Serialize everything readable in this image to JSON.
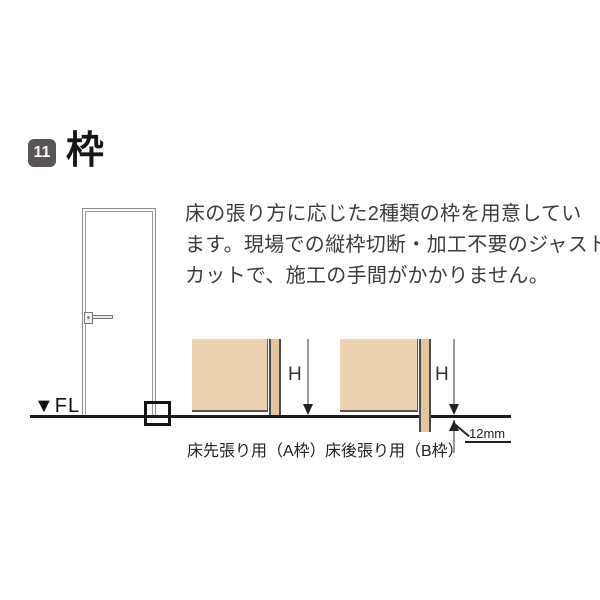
{
  "header": {
    "badge": "11",
    "title": "枠"
  },
  "description": {
    "line1": "床の張り方に応じた2種類の枠を用意してい",
    "line2": "ます。現場での縦枠切断・加工不要のジャスト",
    "line3": "カットで、施工の手間がかかりません。"
  },
  "door_figure": {
    "floor_level_label": "▼FL"
  },
  "diagrams": {
    "a": {
      "label": "床先張り用（A枠）",
      "dimension_label": "H"
    },
    "b": {
      "label": "床後張り用（B枠）",
      "dimension_label": "H",
      "offset_label": "12mm"
    }
  },
  "colors": {
    "badge_bg": "#595557",
    "wall_fill": "#ecd2ae",
    "frame_strip_fill": "#e3c69e",
    "floor_line": "#1b1b1b"
  }
}
